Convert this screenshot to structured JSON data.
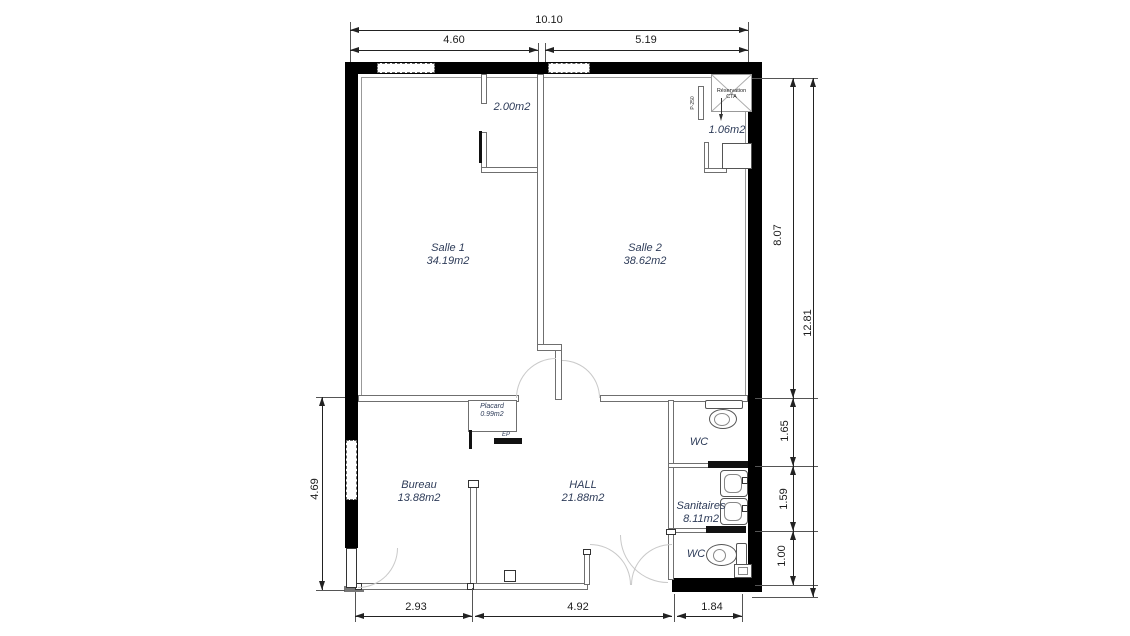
{
  "rooms": {
    "salle1": {
      "name": "Salle 1",
      "area": "34.19m2"
    },
    "salle2": {
      "name": "Salle 2",
      "area": "38.62m2"
    },
    "bureau": {
      "name": "Bureau",
      "area": "13.88m2"
    },
    "hall": {
      "name": "HALL",
      "area": "21.88m2"
    },
    "wc_top": {
      "name": "WC"
    },
    "sanitaires": {
      "name": "Sanitaires",
      "area": "8.11m2"
    },
    "wc_bottom": {
      "name": "WC"
    },
    "placard": {
      "name": "Placard",
      "area": "0.99m2"
    },
    "vestibule": {
      "area": "2.00m2"
    },
    "closet": {
      "area": "1.06m2"
    }
  },
  "annotations": {
    "cta_line1": "Réservation",
    "cta_line2": "CTA",
    "duct": "P-250",
    "electrical_panel": "EP"
  },
  "dimensions": {
    "top_total": "10.10",
    "top_left": "4.60",
    "top_right": "5.19",
    "right_upper": "8.07",
    "right_total": "12.81",
    "right_wc": "1.65",
    "right_sanitaires": "1.59",
    "right_wc_bottom": "1.00",
    "left_lower": "4.69",
    "bottom_left": "2.93",
    "bottom_center": "4.92",
    "bottom_right": "1.84"
  },
  "colors": {
    "wall": "#000000",
    "partition": "#6f6f6f",
    "dimension": "#222222",
    "room_label": "#2e3c59",
    "door_arc": "#c9c9c9"
  }
}
